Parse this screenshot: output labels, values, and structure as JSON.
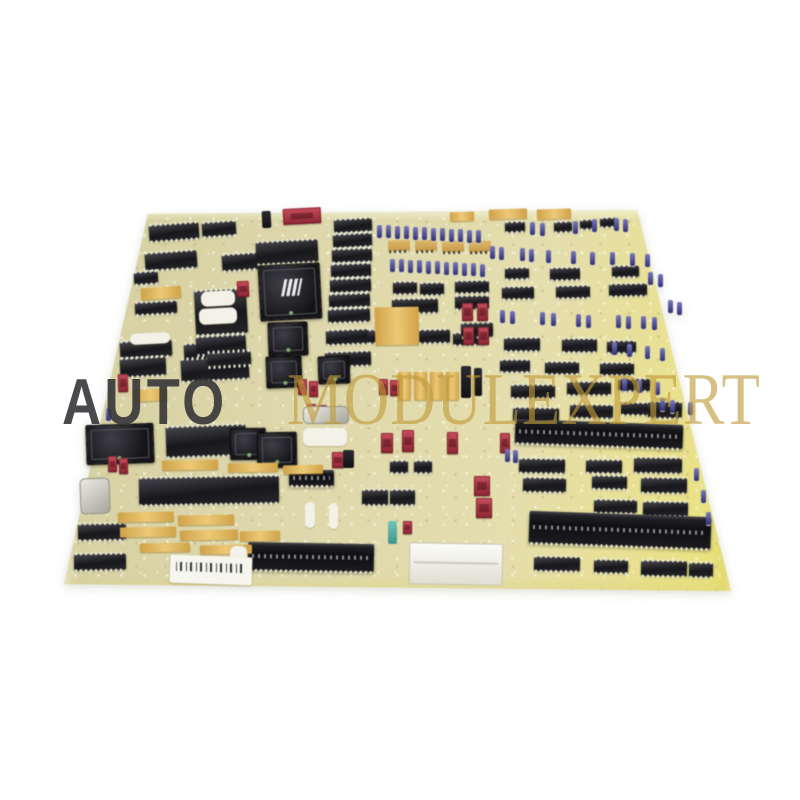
{
  "image_type": "product-photo",
  "subject": "industrial control circuit board, angled view on white background",
  "watermark": {
    "prefix": "AUTO",
    "suffix": "MODULEXPERT"
  },
  "colors": {
    "bg": "#ffffff",
    "pcb-base": "#dbd5a4",
    "pcb-edge-yellow": "#ece377",
    "ic-black": "#1b1b1f",
    "pin-silver": "#e8e8da",
    "gold": "#dcae52",
    "cap-blue": "#4949a0",
    "switch-red": "#b43544",
    "label-white": "#f4f2e8",
    "wm-dark": "#323236",
    "wm-gold": "#c09a38"
  },
  "board": {
    "outline": [
      [
        148,
        214
      ],
      [
        637,
        210
      ],
      [
        731,
        591
      ],
      [
        64,
        584
      ]
    ],
    "components": {
      "dip_ics": [
        [
          149,
          224,
          50,
          16,
          -4
        ],
        [
          202,
          222,
          34,
          14,
          -4
        ],
        [
          145,
          252,
          52,
          17,
          -4
        ],
        [
          222,
          254,
          36,
          16,
          -4
        ],
        [
          256,
          241,
          62,
          22,
          -3
        ],
        [
          134,
          272,
          24,
          12,
          -4
        ],
        [
          135,
          302,
          42,
          12,
          -3
        ],
        [
          120,
          341,
          52,
          16,
          -3
        ],
        [
          184,
          343,
          58,
          16,
          -3
        ],
        [
          120,
          358,
          46,
          18,
          -3
        ],
        [
          181,
          358,
          68,
          22,
          -3
        ],
        [
          195,
          290,
          52,
          44,
          -3
        ],
        [
          196,
          336,
          50,
          18,
          -3
        ],
        [
          207,
          352,
          44,
          14,
          -3
        ],
        [
          334,
          219,
          38,
          13,
          -3
        ],
        [
          333,
          234,
          39,
          13,
          -3
        ],
        [
          332,
          249,
          40,
          13,
          -2
        ],
        [
          331,
          264,
          40,
          13,
          -2
        ],
        [
          330,
          279,
          41,
          13,
          -2
        ],
        [
          329,
          294,
          41,
          13,
          -2
        ],
        [
          328,
          309,
          42,
          13,
          -2
        ],
        [
          326,
          330,
          44,
          14,
          -2
        ],
        [
          325,
          352,
          46,
          14,
          -2
        ],
        [
          393,
          282,
          24,
          12,
          -1
        ],
        [
          420,
          283,
          24,
          12,
          -1
        ],
        [
          455,
          281,
          34,
          12,
          -1
        ],
        [
          392,
          299,
          46,
          14,
          -1
        ],
        [
          455,
          296,
          34,
          13,
          -1
        ],
        [
          368,
          330,
          34,
          13,
          -1
        ],
        [
          408,
          330,
          42,
          13,
          -1
        ],
        [
          453,
          333,
          32,
          12,
          -1
        ],
        [
          505,
          222,
          20,
          10,
          -2
        ],
        [
          554,
          222,
          18,
          10,
          -2
        ],
        [
          580,
          220,
          16,
          9,
          -2
        ],
        [
          600,
          218,
          16,
          9,
          -2
        ],
        [
          446,
          241,
          16,
          9,
          -2
        ],
        [
          470,
          241,
          15,
          9,
          -2
        ],
        [
          505,
          268,
          24,
          11,
          -1
        ],
        [
          550,
          268,
          30,
          12,
          -1
        ],
        [
          612,
          266,
          27,
          11,
          -1
        ],
        [
          502,
          287,
          32,
          12,
          -1
        ],
        [
          556,
          286,
          34,
          12,
          -1
        ],
        [
          609,
          284,
          38,
          12,
          -1
        ],
        [
          461,
          323,
          32,
          14,
          -1
        ],
        [
          504,
          338,
          36,
          13,
          0
        ],
        [
          562,
          339,
          35,
          13,
          0
        ],
        [
          607,
          341,
          29,
          12,
          0
        ],
        [
          500,
          360,
          30,
          12,
          0
        ],
        [
          545,
          362,
          34,
          12,
          0
        ],
        [
          600,
          363,
          34,
          12,
          0
        ],
        [
          511,
          385,
          44,
          13,
          0
        ],
        [
          567,
          382,
          44,
          13,
          0
        ],
        [
          618,
          379,
          32,
          12,
          0
        ],
        [
          513,
          408,
          46,
          14,
          1
        ],
        [
          570,
          405,
          43,
          13,
          1
        ],
        [
          621,
          403,
          33,
          12,
          1
        ],
        [
          648,
          402,
          34,
          16,
          1
        ],
        [
          166,
          426,
          80,
          30,
          -2
        ],
        [
          139,
          477,
          140,
          27,
          -1
        ],
        [
          78,
          524,
          48,
          16,
          -1
        ],
        [
          74,
          554,
          52,
          16,
          -1
        ],
        [
          390,
          461,
          18,
          12,
          0
        ],
        [
          414,
          461,
          18,
          12,
          0
        ],
        [
          362,
          490,
          26,
          15,
          0
        ],
        [
          390,
          490,
          25,
          15,
          0
        ],
        [
          519,
          459,
          46,
          14,
          1
        ],
        [
          586,
          460,
          36,
          13,
          1
        ],
        [
          634,
          458,
          48,
          15,
          1
        ],
        [
          523,
          478,
          43,
          14,
          1
        ],
        [
          592,
          476,
          35,
          13,
          1
        ],
        [
          641,
          478,
          46,
          15,
          1
        ],
        [
          594,
          500,
          43,
          13,
          1
        ],
        [
          643,
          502,
          45,
          14,
          1
        ],
        [
          534,
          557,
          46,
          14,
          1
        ],
        [
          594,
          560,
          34,
          13,
          1
        ],
        [
          641,
          561,
          46,
          15,
          1
        ],
        [
          689,
          563,
          24,
          14,
          1
        ]
      ],
      "gold_dips": [
        [
          388,
          240,
          22,
          11,
          -2
        ],
        [
          415,
          240,
          22,
          11,
          -2
        ],
        [
          442,
          241,
          22,
          11,
          -2
        ],
        [
          469,
          241,
          22,
          11,
          -2
        ]
      ],
      "plcc_chips": [
        [
          259,
          264,
          60,
          54,
          -3,
          1
        ],
        [
          268,
          322,
          38,
          32,
          -2,
          0
        ],
        [
          266,
          356,
          34,
          30,
          -2,
          0
        ],
        [
          318,
          356,
          30,
          26,
          -2,
          0
        ],
        [
          230,
          428,
          34,
          30,
          -1,
          0
        ],
        [
          257,
          432,
          38,
          34,
          -1,
          0
        ],
        [
          86,
          424,
          66,
          38,
          -2,
          0
        ]
      ],
      "ribbon_connectors": [
        [
          515,
          422,
          168,
          24,
          2
        ],
        [
          529,
          514,
          182,
          32,
          2
        ],
        [
          248,
          543,
          126,
          28,
          1
        ],
        [
          289,
          470,
          45,
          16,
          0
        ]
      ],
      "gold_pads": [
        [
          141,
          287,
          40,
          12,
          -4
        ],
        [
          450,
          212,
          24,
          9,
          -2
        ],
        [
          489,
          209,
          38,
          10,
          -2
        ],
        [
          537,
          209,
          34,
          10,
          -2
        ],
        [
          375,
          307,
          44,
          38,
          -1
        ],
        [
          398,
          372,
          13,
          28,
          0
        ],
        [
          414,
          372,
          13,
          28,
          0
        ],
        [
          430,
          372,
          13,
          28,
          0
        ],
        [
          446,
          372,
          13,
          28,
          0
        ],
        [
          133,
          389,
          34,
          12,
          -3
        ],
        [
          162,
          460,
          56,
          10,
          -1
        ],
        [
          228,
          463,
          50,
          9,
          -1
        ],
        [
          283,
          465,
          40,
          9,
          -1
        ],
        [
          118,
          512,
          56,
          10,
          -1
        ],
        [
          178,
          515,
          56,
          10,
          -1
        ],
        [
          120,
          527,
          56,
          10,
          -1
        ],
        [
          180,
          530,
          58,
          10,
          -1
        ],
        [
          240,
          531,
          40,
          10,
          -1
        ],
        [
          140,
          543,
          50,
          9,
          -1
        ],
        [
          200,
          545,
          52,
          9,
          -1
        ]
      ],
      "red_switches": [
        [
          283,
          208,
          38,
          16,
          -3
        ],
        [
          237,
          281,
          12,
          16,
          -3
        ],
        [
          118,
          374,
          10,
          18,
          -2
        ],
        [
          462,
          303,
          11,
          18,
          -1
        ],
        [
          477,
          303,
          11,
          18,
          -1
        ],
        [
          463,
          327,
          11,
          18,
          -1
        ],
        [
          478,
          327,
          11,
          18,
          -1
        ],
        [
          381,
          433,
          12,
          20,
          0
        ],
        [
          402,
          430,
          12,
          22,
          0
        ],
        [
          447,
          432,
          11,
          22,
          0
        ],
        [
          500,
          433,
          10,
          20,
          0
        ],
        [
          474,
          476,
          16,
          20,
          0
        ],
        [
          476,
          498,
          16,
          20,
          0
        ],
        [
          298,
          379,
          9,
          16,
          -1
        ],
        [
          309,
          381,
          9,
          16,
          -1
        ],
        [
          307,
          404,
          9,
          14,
          -1
        ],
        [
          318,
          405,
          9,
          14,
          -1
        ],
        [
          379,
          379,
          9,
          16,
          -1
        ],
        [
          390,
          380,
          9,
          16,
          -1
        ],
        [
          332,
          452,
          12,
          16,
          0
        ],
        [
          403,
          521,
          9,
          13,
          0
        ],
        [
          108,
          456,
          9,
          16,
          -1
        ],
        [
          119,
          458,
          9,
          16,
          -1
        ]
      ],
      "capacitors": [
        [
          377,
          225
        ],
        [
          386,
          225
        ],
        [
          395,
          226
        ],
        [
          404,
          226
        ],
        [
          413,
          227
        ],
        [
          422,
          227
        ],
        [
          431,
          228
        ],
        [
          440,
          228
        ],
        [
          449,
          229
        ],
        [
          458,
          229
        ],
        [
          467,
          230
        ],
        [
          476,
          230
        ],
        [
          390,
          259
        ],
        [
          399,
          259
        ],
        [
          408,
          260
        ],
        [
          417,
          260
        ],
        [
          426,
          261
        ],
        [
          435,
          261
        ],
        [
          444,
          262
        ],
        [
          453,
          262
        ],
        [
          462,
          263
        ],
        [
          471,
          263
        ],
        [
          480,
          264
        ],
        [
          530,
          222
        ],
        [
          540,
          223
        ],
        [
          573,
          221
        ],
        [
          592,
          219
        ],
        [
          614,
          218
        ],
        [
          623,
          219
        ],
        [
          490,
          246
        ],
        [
          499,
          247
        ],
        [
          520,
          248
        ],
        [
          529,
          249
        ],
        [
          546,
          250
        ],
        [
          571,
          251
        ],
        [
          590,
          252
        ],
        [
          610,
          252
        ],
        [
          630,
          253
        ],
        [
          645,
          254
        ],
        [
          500,
          310
        ],
        [
          510,
          311
        ],
        [
          540,
          312
        ],
        [
          551,
          313
        ],
        [
          576,
          314
        ],
        [
          586,
          315
        ],
        [
          616,
          315
        ],
        [
          626,
          316
        ],
        [
          641,
          316
        ],
        [
          652,
          317
        ],
        [
          612,
          342
        ],
        [
          627,
          344
        ],
        [
          645,
          346
        ],
        [
          660,
          348
        ],
        [
          622,
          378
        ],
        [
          637,
          380
        ],
        [
          655,
          382
        ],
        [
          660,
          398
        ],
        [
          670,
          400
        ],
        [
          688,
          402
        ],
        [
          648,
          272
        ],
        [
          658,
          274
        ],
        [
          668,
          300
        ],
        [
          677,
          302
        ],
        [
          694,
          468
        ],
        [
          701,
          490
        ],
        [
          706,
          512
        ],
        [
          106,
          408
        ],
        [
          505,
          449
        ],
        [
          513,
          450
        ]
      ],
      "posts": [
        [
          262,
          211,
          9,
          17,
          -3
        ],
        [
          461,
          366,
          10,
          32,
          0
        ],
        [
          474,
          368,
          8,
          28,
          0
        ],
        [
          343,
          450,
          11,
          18,
          0
        ]
      ],
      "metal_cans": [
        [
          80,
          478,
          28,
          34,
          -2
        ],
        [
          303,
          406,
          44,
          16,
          0
        ]
      ],
      "white_labels": [
        [
          201,
          291,
          34,
          15,
          -3
        ],
        [
          199,
          308,
          38,
          16,
          -3
        ],
        [
          130,
          333,
          40,
          11,
          -3
        ],
        [
          303,
          428,
          44,
          18,
          0
        ],
        [
          329,
          503,
          9,
          26,
          0
        ],
        [
          305,
          502,
          10,
          26,
          0
        ],
        [
          230,
          546,
          17,
          30,
          0
        ]
      ],
      "teal_capacitors": [
        [
          388,
          521,
          9,
          23,
          0
        ]
      ],
      "serial_labels": [
        [
          170,
          556,
          82,
          28,
          2
        ]
      ],
      "white_connectors": [
        [
          409,
          543,
          92,
          40,
          1
        ]
      ]
    }
  }
}
